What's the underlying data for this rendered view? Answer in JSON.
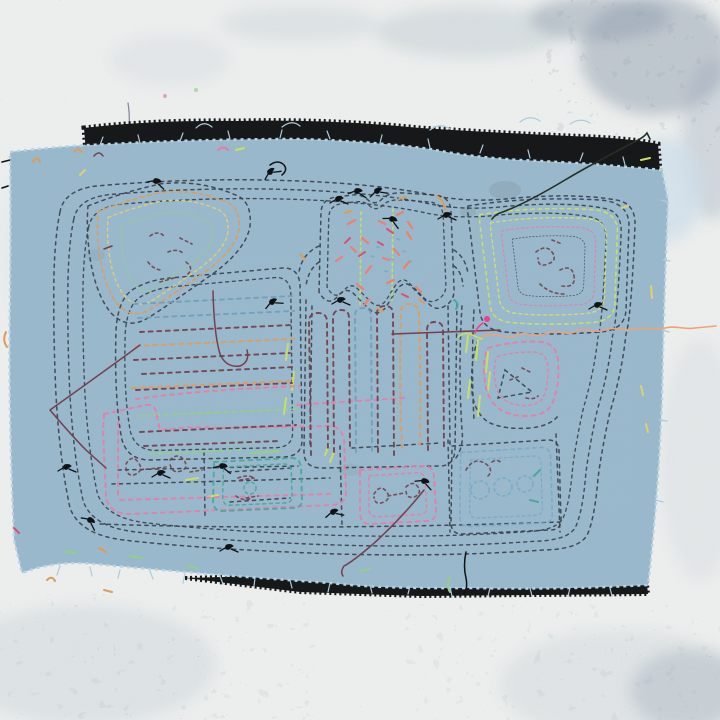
{
  "description": "Photograph of a hand-stitched textile artwork: a frayed light-blue cotton panel sewn with running-stitch outlines (the reverse of a mola-style applique) over a black backing cloth, pinned against a white wall with blue-gray speckled paint.",
  "scene": {
    "background": "white plaster wall with blue-gray speckled paint, densest in the top-right and bottom corners",
    "layers": [
      "black backing fabric visible along top and bottom edges",
      "light blue cotton panel with frayed raw edges"
    ],
    "stitch_style": "dashed running stitches forming concentric echo outlines"
  },
  "motifs": [
    "concentric running-stitch border rings",
    "top-left kite motif ringed in orange, yellow and green",
    "top-center head motif filled with coral, teal and chartreuse confetti stitches",
    "top-right square spiral in chartreuse and pink",
    "right-side pink pentagon with triangle",
    "central column of vertical bar stitches",
    "left block of multicolor horizontal hatching",
    "bottom row of stitched cells with loop glyphs",
    "loose stray threads and black knots",
    "frayed edge tufts"
  ],
  "palette": {
    "wall_base": "#eef0ef",
    "wall_speckle": "#5f6e82",
    "wall_patch": "#93a2b2",
    "wall_stain": "#c9d1d7",
    "black_fabric": "#17181a",
    "fabric_blue": "#9ab9cc",
    "fabric_edge": "#b9d3e2",
    "fabric_fray": "#aecbdc",
    "pale_wash": "#ccdde9",
    "navy": "#39424e",
    "maroon": "#74404e",
    "pink": "#e87ca6",
    "hot_pink": "#ef3f8f",
    "coral": "#ee8168",
    "crimson": "#d6546e",
    "orange": "#df9c58",
    "yellow": "#e2cf70",
    "yellow_green": "#d3de6d",
    "chartreuse": "#c8df63",
    "green": "#94cf87",
    "teal": "#4aa89c",
    "light_blue": "#77aac9",
    "slate_blue": "#6f9fbd",
    "salmon": "#eda277",
    "red": "#c25048",
    "purple_drip": "#8b7d9c",
    "thread_black": "#101214",
    "dark_thread": "#233026"
  }
}
